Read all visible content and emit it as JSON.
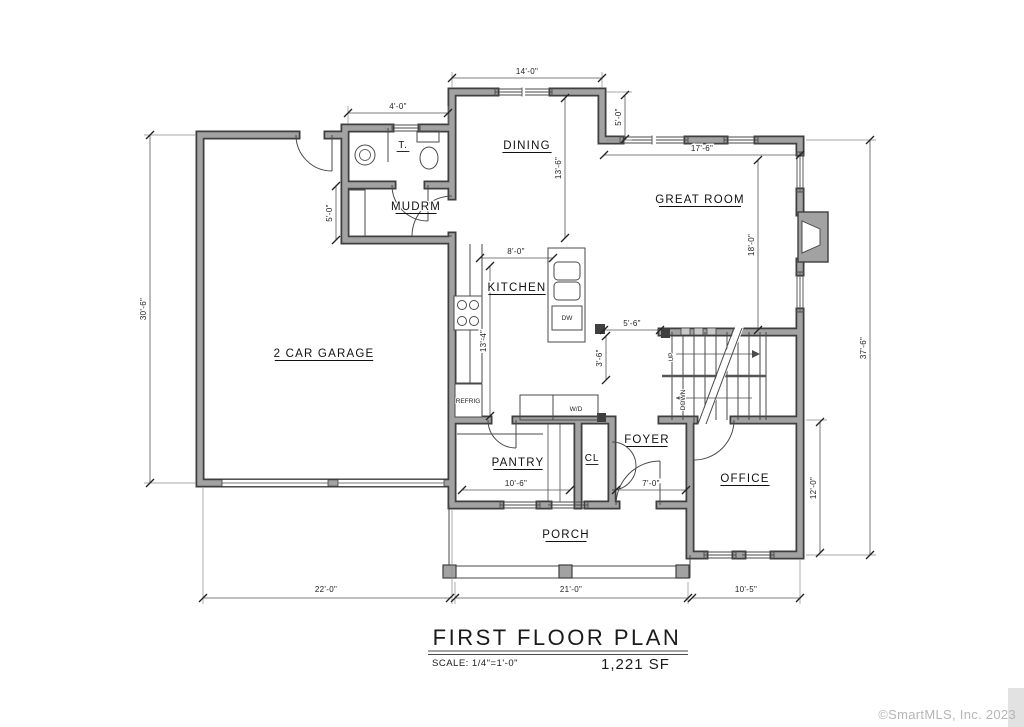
{
  "title": {
    "name": "FIRST FLOOR PLAN",
    "scale": "SCALE: 1/4\"=1'-0\"",
    "area": "1,221 SF"
  },
  "watermark": "©SmartMLS, Inc.  2023",
  "colors": {
    "wall_edge": "#3f3f3f",
    "wall_fill": "#a2a2a2",
    "line": "#4a4a4a",
    "dim": "#555555",
    "text": "#111111",
    "watermark": "#b5b5b5"
  },
  "rooms": [
    {
      "label": "DINING",
      "x": 527,
      "y": 149
    },
    {
      "label": "GREAT ROOM",
      "x": 700,
      "y": 203
    },
    {
      "label": "T.",
      "x": 403,
      "y": 148,
      "small": true
    },
    {
      "label": "MUDRM",
      "x": 416,
      "y": 210
    },
    {
      "label": "KITCHEN",
      "x": 517,
      "y": 291
    },
    {
      "label": "2 CAR GARAGE",
      "x": 324,
      "y": 357
    },
    {
      "label": "PANTRY",
      "x": 518,
      "y": 466
    },
    {
      "label": "CL",
      "x": 592,
      "y": 461,
      "small": true
    },
    {
      "label": "FOYER",
      "x": 647,
      "y": 443
    },
    {
      "label": "OFFICE",
      "x": 745,
      "y": 482
    },
    {
      "label": "PORCH",
      "x": 566,
      "y": 538
    }
  ],
  "fixtures": [
    {
      "label": "REFRIG",
      "x": 468,
      "y": 403,
      "size": 5.5
    },
    {
      "label": "DW",
      "x": 567,
      "y": 320,
      "size": 7
    },
    {
      "label": "W/D",
      "x": 576,
      "y": 411,
      "size": 7
    },
    {
      "label": "UP",
      "x": 673,
      "y": 357,
      "size": 7,
      "rot": -90
    },
    {
      "label": "DOWN",
      "x": 685,
      "y": 400,
      "size": 6,
      "rot": -90
    }
  ],
  "dimensions": [
    {
      "label": "14'-0\"",
      "x1": 452,
      "y1": 78,
      "x2": 602,
      "y2": 78,
      "lx": 527,
      "ly": 74,
      "rot": 0
    },
    {
      "label": "4'-0\"",
      "x1": 348,
      "y1": 113,
      "x2": 448,
      "y2": 113,
      "lx": 398,
      "ly": 109,
      "rot": 0
    },
    {
      "label": "5'-0\"",
      "x1": 625,
      "y1": 95,
      "x2": 625,
      "y2": 139,
      "lx": 621,
      "ly": 117,
      "rot": -90
    },
    {
      "label": "17'-6\"",
      "x1": 604,
      "y1": 155,
      "x2": 800,
      "y2": 155,
      "lx": 702,
      "ly": 151,
      "rot": 0
    },
    {
      "label": "18'-0\"",
      "x1": 758,
      "y1": 160,
      "x2": 758,
      "y2": 330,
      "lx": 754,
      "ly": 245,
      "rot": -90
    },
    {
      "label": "13'-6\"",
      "x1": 565,
      "y1": 98,
      "x2": 565,
      "y2": 238,
      "lx": 561,
      "ly": 168,
      "rot": -90
    },
    {
      "label": "5'-0\"",
      "x1": 336,
      "y1": 186,
      "x2": 336,
      "y2": 240,
      "lx": 332,
      "ly": 213,
      "rot": -90
    },
    {
      "label": "30'-6\"",
      "x1": 150,
      "y1": 135,
      "x2": 150,
      "y2": 483,
      "lx": 146,
      "ly": 309,
      "rot": -90
    },
    {
      "label": "37'-6\"",
      "x1": 870,
      "y1": 140,
      "x2": 870,
      "y2": 555,
      "lx": 866,
      "ly": 348,
      "rot": -90
    },
    {
      "label": "8'-0\"",
      "x1": 480,
      "y1": 258,
      "x2": 553,
      "y2": 258,
      "lx": 516,
      "ly": 254,
      "rot": 0
    },
    {
      "label": "13'-4\"",
      "x1": 490,
      "y1": 266,
      "x2": 490,
      "y2": 416,
      "lx": 486,
      "ly": 341,
      "rot": -90
    },
    {
      "label": "5'-6\"",
      "x1": 604,
      "y1": 330,
      "x2": 660,
      "y2": 330,
      "lx": 632,
      "ly": 326,
      "rot": 0
    },
    {
      "label": "3'-6\"",
      "x1": 606,
      "y1": 336,
      "x2": 606,
      "y2": 380,
      "lx": 602,
      "ly": 358,
      "rot": -90
    },
    {
      "label": "10'-6\"",
      "x1": 462,
      "y1": 490,
      "x2": 570,
      "y2": 490,
      "lx": 516,
      "ly": 486,
      "rot": 0
    },
    {
      "label": "7'-0\"",
      "x1": 616,
      "y1": 490,
      "x2": 686,
      "y2": 490,
      "lx": 651,
      "ly": 486,
      "rot": 0
    },
    {
      "label": "12'-0\"",
      "x1": 820,
      "y1": 422,
      "x2": 820,
      "y2": 553,
      "lx": 816,
      "ly": 488,
      "rot": -90
    },
    {
      "label": "22'-0\"",
      "x1": 203,
      "y1": 598,
      "x2": 450,
      "y2": 598,
      "lx": 326,
      "ly": 592,
      "rot": 0
    },
    {
      "label": "21'-0\"",
      "x1": 455,
      "y1": 598,
      "x2": 688,
      "y2": 598,
      "lx": 571,
      "ly": 592,
      "rot": 0
    },
    {
      "label": "10'-5\"",
      "x1": 692,
      "y1": 598,
      "x2": 800,
      "y2": 598,
      "lx": 746,
      "ly": 592,
      "rot": 0
    }
  ]
}
